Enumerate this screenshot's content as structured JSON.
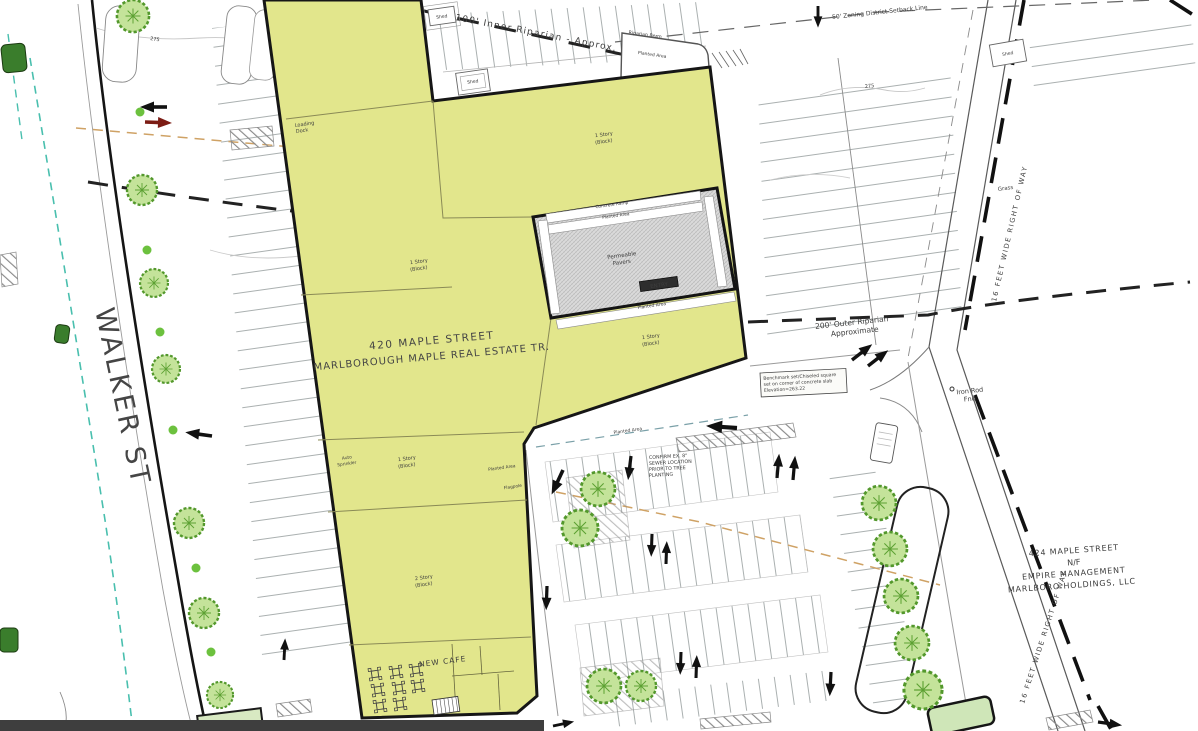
{
  "streets": {
    "walker": "WALKER ST"
  },
  "parcels": {
    "main": [
      "420 MAPLE STREET",
      "MARLBOROUGH MAPLE REAL ESTATE TR."
    ],
    "neighbor": [
      "424 MAPLE STREET",
      "N/F",
      "EMPIRE MANAGEMENT",
      "MARLBORO HOLDINGS, LLC"
    ]
  },
  "annotations": {
    "inner_riparian": "100' Inner Riparian - Approx.",
    "outer_riparian": [
      "200' Outer Riparian",
      "Approximate"
    ],
    "zoning_setback": "50' Zoning District Setback Line",
    "right_of_way": "16 FEET WIDE RIGHT OF WAY",
    "iron_rod": [
      "Iron Rod",
      "Fnd"
    ],
    "grass": "Grass",
    "shed": "Shed",
    "riparian_berm": "Riparian Berm",
    "planted_area": "Planted Area",
    "concrete_ramp": "Concrete Ramp",
    "permeable_pavers": [
      "Permeable",
      "Pavers"
    ],
    "entry": "ENTRY",
    "loading_dock": [
      "Loading",
      "Dock"
    ],
    "story_1": [
      "1 Story",
      "(Block)"
    ],
    "story_2": [
      "2 Story",
      "(Block)"
    ],
    "auto_sprinkler": [
      "Auto",
      "Sprinkler"
    ],
    "flagpole": "Flagpole",
    "new_cafe": "NEW CAFE",
    "sewer_note": [
      "CONFIRM EX. 8\"",
      "SEWER LOCATION",
      "PRIOR TO TREE",
      "PLANTING"
    ],
    "benchmark": [
      "Benchmark set/Chiseled square",
      "set on corner of concrete slab",
      "Elevation=263.22"
    ],
    "contour_275": "275"
  },
  "colors": {
    "building_fill": "#e2e68c",
    "outline": "#161616",
    "tree_fill": "#c4e39a",
    "tree_stroke": "#53982c",
    "teal_line": "#49bfae",
    "tan_line": "#cfa265",
    "red_arrow": "#7c1c14",
    "bottom_bar": "#3e3e3e"
  }
}
